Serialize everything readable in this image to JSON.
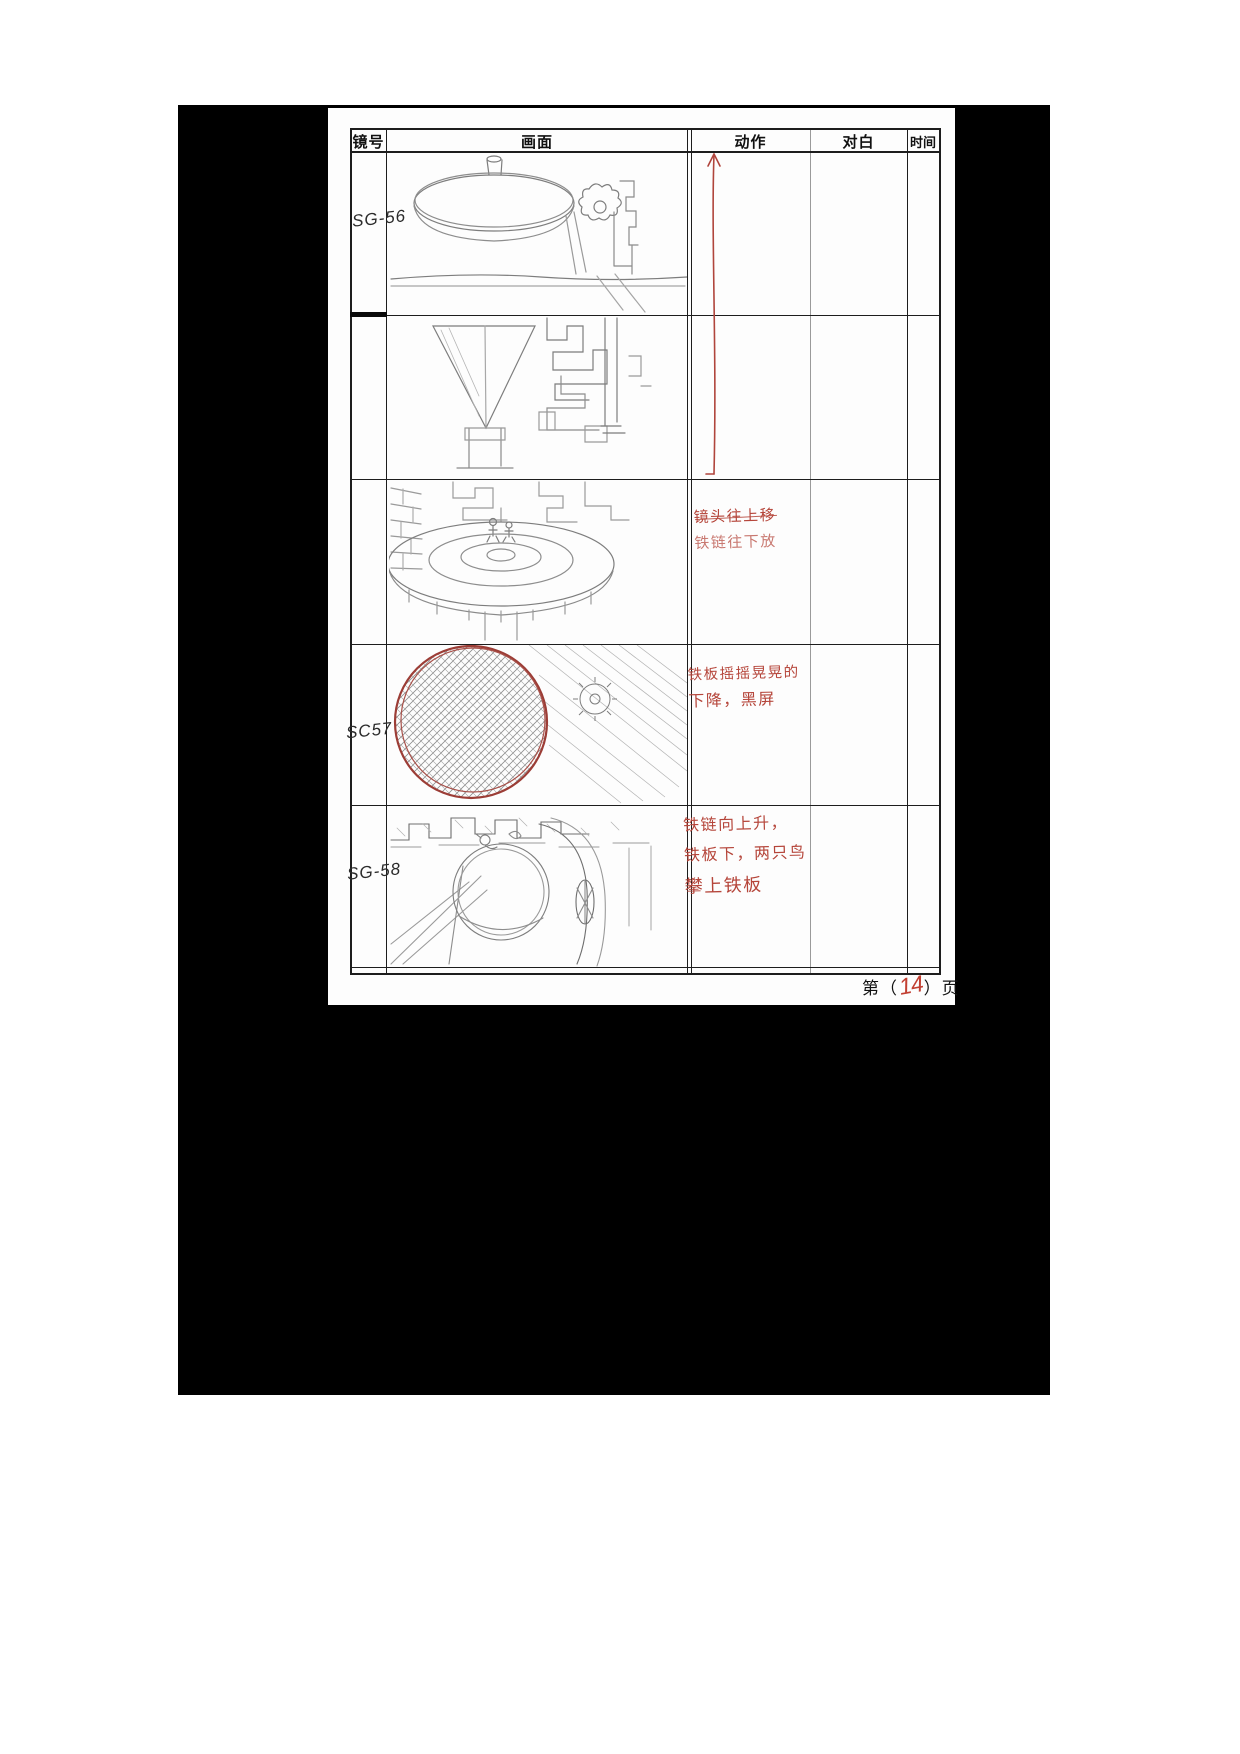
{
  "document": {
    "type": "storyboard-scan",
    "footer": {
      "prefix": "第（",
      "page_number": "14",
      "suffix": "）页"
    }
  },
  "table": {
    "headers": [
      "镜号",
      "画面",
      "动作",
      "对白",
      "时间"
    ]
  },
  "rows": [
    {
      "shot_id": "SG-56",
      "sketch": "hanging-disc-with-gears",
      "action_text": [],
      "dialogue": "",
      "time": ""
    },
    {
      "shot_id": "",
      "sketch": "cone-and-meander-blocks",
      "action_text": [],
      "dialogue": "",
      "time": ""
    },
    {
      "shot_id": "",
      "sketch": "round-platform-with-figures",
      "action_text": [
        "镜头往上移",
        "铁链往下放"
      ],
      "dialogue": "",
      "time": ""
    },
    {
      "shot_id": "SC57",
      "sketch": "dark-hatched-sphere-red-outline",
      "action_text": [
        "铁板摇摇晃晃的",
        "下降，黑屏"
      ],
      "dialogue": "",
      "time": ""
    },
    {
      "shot_id": "SG-58",
      "sketch": "pit-platform-with-birds-and-gear",
      "action_text": [
        "铁链向上升，",
        "铁板下，两只鸟",
        "攀上铁板"
      ],
      "dialogue": "",
      "time": ""
    }
  ],
  "annotations": {
    "camera_arrow_direction": "up"
  },
  "colors": {
    "ink": "#1d1d1d",
    "pencil": "#8a8a8a",
    "annotation_red": "#b5453a",
    "sketch_red": "#9c3d36",
    "mat_black": "#000000"
  }
}
